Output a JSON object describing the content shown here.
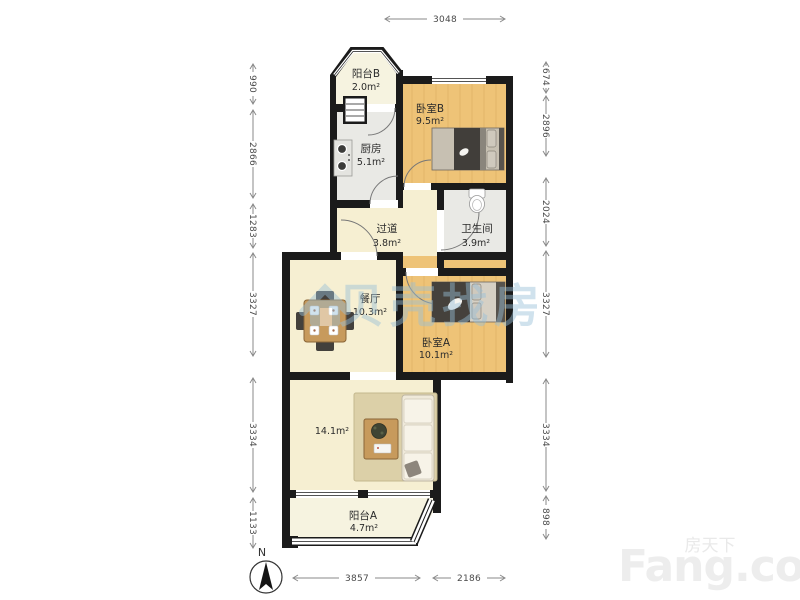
{
  "plan": {
    "rooms": [
      {
        "key": "balcony-b",
        "name": "阳台B",
        "area": "2.0m²"
      },
      {
        "key": "bedroom-b",
        "name": "卧室B",
        "area": "9.5m²"
      },
      {
        "key": "kitchen",
        "name": "厨房",
        "area": "5.1m²"
      },
      {
        "key": "hallway",
        "name": "过道",
        "area": "3.8m²"
      },
      {
        "key": "bathroom",
        "name": "卫生间",
        "area": "3.9m²"
      },
      {
        "key": "dining",
        "name": "餐厅",
        "area": "10.3m²"
      },
      {
        "key": "bedroom-a",
        "name": "卧室A",
        "area": "10.1m²"
      },
      {
        "key": "living",
        "name": "",
        "area": "14.1m²"
      },
      {
        "key": "balcony-a",
        "name": "阳台A",
        "area": "4.7m²"
      }
    ],
    "dimensions": {
      "top": [
        "3048"
      ],
      "bottom": [
        "3857",
        "2186"
      ],
      "left": [
        "990",
        "2866",
        "1283",
        "3327",
        "3334",
        "1133"
      ],
      "right": [
        "674",
        "2896",
        "2024",
        "3327",
        "3334",
        "898"
      ]
    },
    "compass_label": "N"
  },
  "watermarks": {
    "center_text": "贝壳找房",
    "bottom_right_cn": "房天下",
    "bottom_right_en": "Fang.com"
  },
  "colors": {
    "wall": "#1b1b1b",
    "room_warm": "#eec377",
    "room_light": "#f6efd2",
    "room_gray": "#e9e9e5",
    "balcony": "#f6f3e0",
    "watermark_blue": "#98bfd8"
  }
}
